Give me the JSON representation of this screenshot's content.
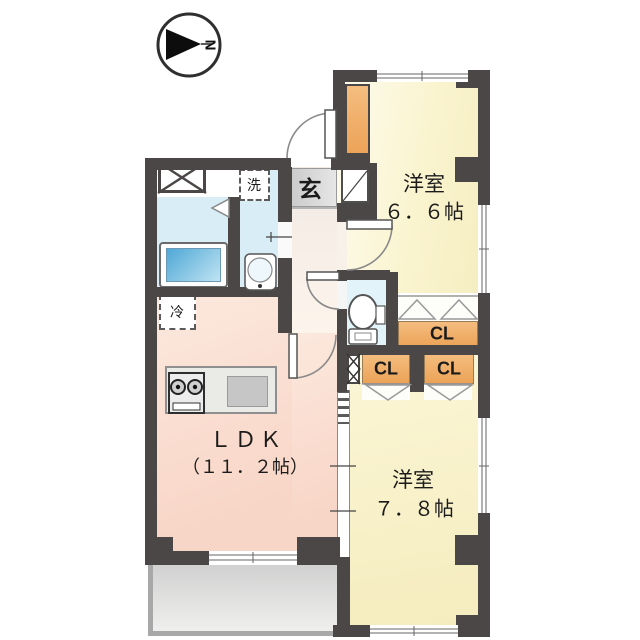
{
  "compass": {
    "north_label": "N"
  },
  "rooms": {
    "western_66": {
      "name": "洋室",
      "size": "６．６帖"
    },
    "western_78": {
      "name": "洋室",
      "size": "７．８帖"
    },
    "ldk": {
      "name": "ＬＤＫ",
      "size": "（１１．２帖）"
    }
  },
  "fixtures": {
    "entrance_label": "玄",
    "laundry_label": "洗",
    "fridge_label": "冷"
  },
  "closets": {
    "cl_66": {
      "label": "CL"
    },
    "cl_78_left": {
      "label": "CL"
    },
    "cl_78_right": {
      "label": "CL"
    }
  },
  "colors": {
    "wall": "#4b4747",
    "room_yellow": "#faf3cd",
    "ldk_pink": "#f8d6c7",
    "closet_orange": "#eca358",
    "water_blue": "#d8edf5",
    "toilet_blue": "#e2f3f9",
    "balcony_gray": "#d9d9d9",
    "genkan_gray": "#d6d6d6"
  }
}
